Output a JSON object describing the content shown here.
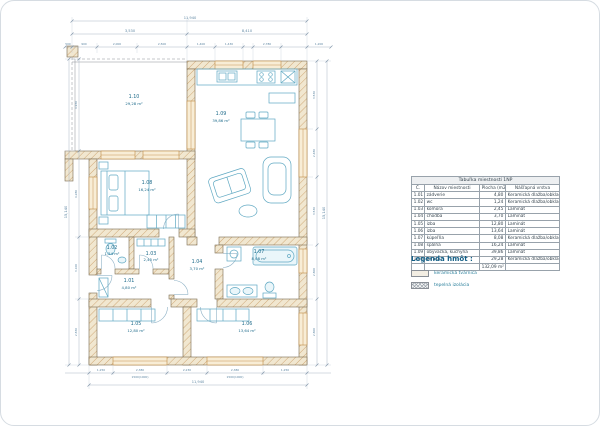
{
  "table": {
    "title": "Tabuľka miestností 1NP",
    "headers": [
      "Č.",
      "Názov miestnosti",
      "Plocha (m2)",
      "Nášľapná vrstva"
    ],
    "rows": [
      [
        "1.01",
        "zádverie",
        "4,80",
        "Keramická dlažba/obklad"
      ],
      [
        "1.02",
        "wc",
        "1,24",
        "Keramická dlažba/obklad"
      ],
      [
        "1.03",
        "komora",
        "2,45",
        "Laminát"
      ],
      [
        "1.04",
        "chodba",
        "3,70",
        "Laminát"
      ],
      [
        "1.05",
        "izba",
        "12,80",
        "Laminát"
      ],
      [
        "1.06",
        "izba",
        "13,64",
        "Laminát"
      ],
      [
        "1.07",
        "kúpeľňa",
        "8,08",
        "Keramická dlažba/obklad"
      ],
      [
        "1.08",
        "spálňa",
        "16,24",
        "Laminát"
      ],
      [
        "1.09",
        "obývačka, kuchyňa",
        "39,86",
        "Laminát"
      ],
      [
        "1.10",
        "terasa",
        "29,28",
        "Keramická dlažba/obklad"
      ]
    ],
    "total": "132,09 m²"
  },
  "legend": {
    "title": "Legenda hmôt :",
    "items": [
      {
        "label": "keramická tvárnica",
        "swatch": "solid"
      },
      {
        "label": "tepelná izolácia",
        "swatch": "hatch"
      }
    ]
  },
  "plan": {
    "rooms": {
      "r101": {
        "num": "1.01",
        "area": "4,80 m²"
      },
      "r102": {
        "num": "1.02",
        "area": "1,24 m²"
      },
      "r103": {
        "num": "1.03",
        "area": "2,45 m²"
      },
      "r104": {
        "num": "1.04",
        "area": "3,70 m²"
      },
      "r105": {
        "num": "1.05",
        "area": "12,80 m²"
      },
      "r106": {
        "num": "1.06",
        "area": "13,64 m²"
      },
      "r107": {
        "num": "1.07",
        "area": "8,08 m²"
      },
      "r108": {
        "num": "1.08",
        "area": "16,24 m²"
      },
      "r109": {
        "num": "1.09",
        "area": "39,86 m²"
      },
      "r110": {
        "num": "1.10",
        "area": "29,28 m²"
      }
    },
    "dims": {
      "top_overall": "11,940",
      "top_seg1": "3,530",
      "top_seg2": "8,410",
      "top_small": [
        "500",
        "900",
        "2,000",
        "2,500",
        "1,400",
        "1,430",
        "2,780",
        "1,200"
      ],
      "bottom_small": [
        "1,250",
        "2,380",
        "2,230",
        "2,380",
        "1,250"
      ],
      "bottom_win": "1500(1000)",
      "bottom_overall": "11,940",
      "left_overall": "15,140",
      "left_segs": [
        "4,930",
        "4,280",
        "3,100",
        "2,830"
      ],
      "right_overall": "15,140",
      "right_segs": [
        "3,530",
        "2,480",
        "3,530",
        "2,800",
        "2,800"
      ]
    }
  },
  "colors": {
    "wall_fill": "#f1e7d0",
    "wall_hatch": "#cfa877",
    "window": "#c08a45",
    "fixture": "#5fa8c2",
    "dimension": "#5f87a3",
    "label": "#1d6a8a",
    "legend_accent": "#135f86"
  }
}
